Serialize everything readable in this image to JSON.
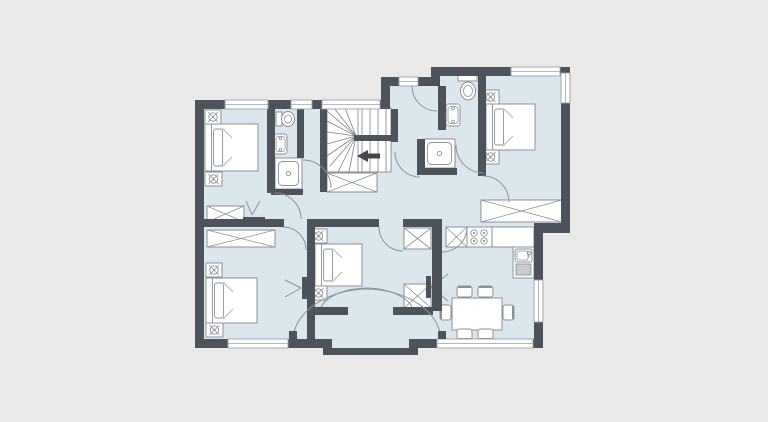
{
  "palette": {
    "bg": "#e9e9e7",
    "floor": "#dbe7ed",
    "wall": "#4d535a",
    "wall_dark": "#41474d",
    "stroke": "#8a929a",
    "stroke_light": "#aab1b8",
    "white": "#ffffff",
    "window_line": "#9aa1a8",
    "appliance": "#c7cbd0"
  },
  "canvas": {
    "width": 768,
    "height": 422
  },
  "building": {
    "outline": "195,100 390,100 390,77 440,77 440,67 570,67 570,233 543,233 543,348 418,348 418,355 323,355 323,348 195,348",
    "exterior_walls": [
      [
        195,
        100,
        190,
        9
      ],
      [
        381,
        77,
        9,
        32
      ],
      [
        381,
        77,
        59,
        9
      ],
      [
        431,
        67,
        9,
        19
      ],
      [
        431,
        67,
        139,
        9
      ],
      [
        561,
        67,
        9,
        166
      ],
      [
        543,
        223,
        27,
        10
      ],
      [
        534,
        223,
        9,
        125
      ],
      [
        195,
        339,
        133,
        9
      ],
      [
        409,
        339,
        134,
        9
      ],
      [
        323,
        339,
        9,
        16
      ],
      [
        323,
        348,
        95,
        7
      ],
      [
        409,
        339,
        9,
        16
      ],
      [
        195,
        100,
        9,
        248
      ]
    ],
    "interior_walls": [
      [
        267,
        109,
        8,
        84
      ],
      [
        204,
        219,
        80,
        8
      ],
      [
        307,
        219,
        8,
        120
      ],
      [
        307,
        219,
        72,
        8
      ],
      [
        403,
        219,
        30,
        8
      ],
      [
        432,
        219,
        10,
        92
      ],
      [
        307,
        307,
        41,
        8
      ],
      [
        393,
        307,
        40,
        8
      ],
      [
        478,
        76,
        8,
        100
      ],
      [
        438,
        86,
        8,
        44
      ],
      [
        417,
        139,
        8,
        36
      ],
      [
        417,
        168,
        40,
        7
      ],
      [
        320,
        109,
        7,
        83
      ],
      [
        391,
        109,
        7,
        33
      ],
      [
        297,
        109,
        7,
        49
      ],
      [
        271,
        189,
        32,
        6
      ]
    ],
    "windows": [
      {
        "name": "window-bedroom-top-left",
        "r": [
          225,
          100,
          43,
          9
        ],
        "o": "h"
      },
      {
        "name": "window-bathroom-1",
        "r": [
          291,
          100,
          21,
          9
        ],
        "o": "h"
      },
      {
        "name": "window-stairs",
        "r": [
          322,
          100,
          58,
          9
        ],
        "o": "h"
      },
      {
        "name": "window-hall-top",
        "r": [
          399,
          77,
          19,
          9
        ],
        "o": "h"
      },
      {
        "name": "window-bedroom-top-right-top",
        "r": [
          511,
          67,
          49,
          9
        ],
        "o": "h"
      },
      {
        "name": "window-bedroom-top-right-side",
        "r": [
          561,
          73,
          9,
          30
        ],
        "o": "v"
      },
      {
        "name": "window-kitchen-side",
        "r": [
          534,
          280,
          9,
          42
        ],
        "o": "v"
      },
      {
        "name": "window-bedroom-bottom-left",
        "r": [
          228,
          339,
          60,
          9
        ],
        "o": "h"
      },
      {
        "name": "window-dining-bottom",
        "r": [
          437,
          339,
          96,
          9
        ],
        "o": "h"
      }
    ],
    "doors": [
      {
        "name": "door-arc-bathroom-1",
        "path": "M303,160 A28,28 0 0 1 331,188"
      },
      {
        "name": "door-arc-bedroom-top-left",
        "path": "M275,193 A26,26 0 0 1 301,219"
      },
      {
        "name": "door-arc-bedroom-bottom-left",
        "path": "M283,227 A23,23 0 0 1 306,250"
      },
      {
        "name": "door-arc-bedroom-middle-top",
        "path": "M379,227 A24,24 0 0 0 403,251"
      },
      {
        "name": "door-arc-hall-top",
        "path": "M412,86 A25,25 0 0 0 437,111"
      },
      {
        "name": "door-arc-bathroom-2",
        "path": "M456,145 A28,28 0 0 0 484,173"
      },
      {
        "name": "door-arc-bedroom-top-right",
        "path": "M483,176 A26,26 0 0 1 509,202"
      },
      {
        "name": "door-arc-kitchen",
        "path": "M442,252 A25,25 0 0 0 467,227"
      },
      {
        "name": "door-arc-stairs-hall",
        "path": "M395,152 A25,25 0 0 0 420,177"
      },
      {
        "name": "entry-door-arc-left",
        "path": "M293,338 A76,52 0 0 1 368,289"
      },
      {
        "name": "entry-door-arc-right",
        "path": "M441,338 A76,52 0 0 0 368,289"
      },
      {
        "name": "door-arc-bedroom-middle-left",
        "path": "M321,307 A49,26 0 0 1 368,288"
      },
      {
        "name": "door-arc-bedroom-middle-right",
        "path": "M412,307 A49,26 0 0 0 368,288"
      }
    ],
    "door_leaves": [
      [
        289,
        331,
        8,
        8
      ],
      [
        438,
        331,
        8,
        8
      ]
    ]
  },
  "stairs": {
    "name": "staircase",
    "base": [
      327,
      108,
      64,
      64
    ],
    "treads": [
      [
        362,
        108,
        362,
        135
      ],
      [
        370,
        108,
        370,
        135
      ],
      [
        378,
        108,
        378,
        135
      ],
      [
        386,
        108,
        386,
        135
      ],
      [
        362,
        141,
        362,
        172
      ],
      [
        370,
        141,
        370,
        172
      ],
      [
        378,
        141,
        378,
        172
      ],
      [
        386,
        141,
        386,
        172
      ]
    ],
    "rail": [
      358,
      108,
      358,
      172
    ],
    "divider": [
      354,
      135,
      44,
      6
    ],
    "fan_focus": [
      356,
      136
    ],
    "fan_ends": [
      [
        327,
        111
      ],
      [
        327,
        121
      ],
      [
        327,
        132
      ],
      [
        327,
        144
      ],
      [
        327,
        156
      ],
      [
        330,
        166
      ],
      [
        338,
        172
      ],
      [
        349,
        172
      ],
      [
        334,
        108
      ],
      [
        345,
        108
      ]
    ],
    "arrow_points": "357,156 368,150 368,153.5 380,153.5 380,158.5 368,158.5 368,162"
  },
  "furniture": [
    {
      "type": "bed",
      "name": "double-bed-top-left",
      "x": 205,
      "y": 124,
      "w": 53,
      "h": 47
    },
    {
      "type": "bed",
      "name": "double-bed-top-right",
      "x": 486,
      "y": 104,
      "w": 49,
      "h": 46
    },
    {
      "type": "bed",
      "name": "double-bed-bottom-left",
      "x": 206,
      "y": 278,
      "w": 51,
      "h": 45
    },
    {
      "type": "bed",
      "name": "double-bed-middle",
      "x": 315,
      "y": 244,
      "w": 47,
      "h": 42
    },
    {
      "type": "nightstand",
      "name": "nightstand",
      "x": 205,
      "y": 110,
      "w": 16,
      "h": 14
    },
    {
      "type": "nightstand",
      "name": "nightstand",
      "x": 205,
      "y": 172,
      "w": 17,
      "h": 14
    },
    {
      "type": "nightstand",
      "name": "nightstand",
      "x": 482,
      "y": 90,
      "w": 17,
      "h": 14
    },
    {
      "type": "nightstand",
      "name": "nightstand",
      "x": 482,
      "y": 150,
      "w": 17,
      "h": 14
    },
    {
      "type": "nightstand",
      "name": "nightstand",
      "x": 206,
      "y": 263,
      "w": 16,
      "h": 14
    },
    {
      "type": "nightstand",
      "name": "nightstand",
      "x": 206,
      "y": 323,
      "w": 17,
      "h": 14
    },
    {
      "type": "nightstand",
      "name": "nightstand",
      "x": 310,
      "y": 229,
      "w": 17,
      "h": 14
    },
    {
      "type": "nightstand",
      "name": "nightstand",
      "x": 310,
      "y": 286,
      "w": 17,
      "h": 14
    },
    {
      "type": "xbox",
      "name": "wardrobe-top-left",
      "x": 207,
      "y": 206,
      "w": 37,
      "h": 16
    },
    {
      "type": "xbox",
      "name": "wardrobe-bottom-left",
      "x": 207,
      "y": 230,
      "w": 68,
      "h": 17
    },
    {
      "type": "xbox",
      "name": "wardrobe-top-right",
      "x": 481,
      "y": 200,
      "w": 81,
      "h": 22
    },
    {
      "type": "xbox",
      "name": "closet-under-stairs",
      "x": 327,
      "y": 173,
      "w": 50,
      "h": 19
    },
    {
      "type": "xbox",
      "name": "closet-hall-upper",
      "x": 404,
      "y": 228,
      "w": 27,
      "h": 21
    },
    {
      "type": "xbox",
      "name": "closet-hall-lower",
      "x": 404,
      "y": 284,
      "w": 27,
      "h": 24
    },
    {
      "type": "xbox",
      "name": "kitchen-cabinet",
      "x": 446,
      "y": 227,
      "w": 21,
      "h": 20
    },
    {
      "type": "toilet",
      "name": "toilet-bathroom-1",
      "tank": [
        276,
        112,
        6,
        14
      ],
      "cx": 288,
      "cy": 119,
      "rx": 6.5,
      "ry": 7.5
    },
    {
      "type": "toilet",
      "name": "toilet-bathroom-2",
      "tank": [
        458,
        74,
        19,
        7
      ],
      "cx": 468,
      "cy": 91,
      "rx": 7.5,
      "ry": 9
    },
    {
      "type": "sink",
      "name": "sink-bathroom-1",
      "x": 274,
      "y": 134,
      "w": 13,
      "h": 20
    },
    {
      "type": "sink",
      "name": "sink-bathroom-2",
      "x": 446,
      "y": 104,
      "w": 14,
      "h": 22
    },
    {
      "type": "shower",
      "name": "shower-bathroom-1",
      "x": 275,
      "y": 158,
      "w": 27,
      "h": 31
    },
    {
      "type": "shower",
      "name": "shower-bathroom-2",
      "x": 424,
      "y": 139,
      "w": 31,
      "h": 29
    },
    {
      "type": "counter",
      "name": "kitchen-counter-top",
      "x": 467,
      "y": 227,
      "w": 67,
      "h": 20
    },
    {
      "type": "counter",
      "name": "kitchen-counter-side",
      "x": 513,
      "y": 247,
      "w": 21,
      "h": 31
    },
    {
      "type": "stove",
      "name": "stove",
      "x": 467,
      "y": 227,
      "w": 25,
      "h": 20
    },
    {
      "type": "ksink",
      "name": "kitchen-sink",
      "x": 515,
      "y": 249,
      "w": 17,
      "h": 13
    },
    {
      "type": "appliance",
      "name": "dishwasher",
      "x": 516,
      "y": 264,
      "w": 15,
      "h": 11
    },
    {
      "type": "table",
      "name": "dining-table",
      "x": 452,
      "y": 298,
      "w": 50,
      "h": 32
    },
    {
      "type": "chair",
      "name": "dining-chair",
      "x": 457,
      "y": 286,
      "w": 15,
      "h": 11,
      "back": "N"
    },
    {
      "type": "chair",
      "name": "dining-chair",
      "x": 478,
      "y": 286,
      "w": 15,
      "h": 11,
      "back": "N"
    },
    {
      "type": "chair",
      "name": "dining-chair",
      "x": 457,
      "y": 329,
      "w": 15,
      "h": 11,
      "back": "S"
    },
    {
      "type": "chair",
      "name": "dining-chair",
      "x": 478,
      "y": 329,
      "w": 15,
      "h": 11,
      "back": "S"
    },
    {
      "type": "chair",
      "name": "dining-chair",
      "x": 440,
      "y": 305,
      "w": 11,
      "h": 15,
      "back": "W"
    },
    {
      "type": "chair",
      "name": "dining-chair",
      "x": 503,
      "y": 305,
      "w": 11,
      "h": 15,
      "back": "E"
    },
    {
      "type": "desk",
      "name": "desk-top-left",
      "x": 243,
      "y": 217,
      "w": 22,
      "h": 5
    },
    {
      "type": "desk",
      "name": "desk-bottom-left",
      "x": 302,
      "y": 277,
      "w": 5,
      "h": 22
    },
    {
      "type": "desk",
      "name": "desk-middle",
      "x": 426,
      "y": 276,
      "w": 5,
      "h": 22
    },
    {
      "type": "chairlines",
      "name": "desk-chair-top-left",
      "pts": [
        [
          246,
          201
        ],
        [
          252,
          215
        ],
        [
          260,
          201
        ]
      ]
    },
    {
      "type": "chairlines",
      "name": "desk-chair-bottom-left",
      "pts": [
        [
          285,
          280
        ],
        [
          301,
          288
        ],
        [
          285,
          297
        ]
      ]
    },
    {
      "type": "chairlines",
      "name": "desk-chair-middle",
      "pts": [
        [
          448,
          274
        ],
        [
          431,
          287
        ],
        [
          448,
          301
        ]
      ]
    }
  ]
}
